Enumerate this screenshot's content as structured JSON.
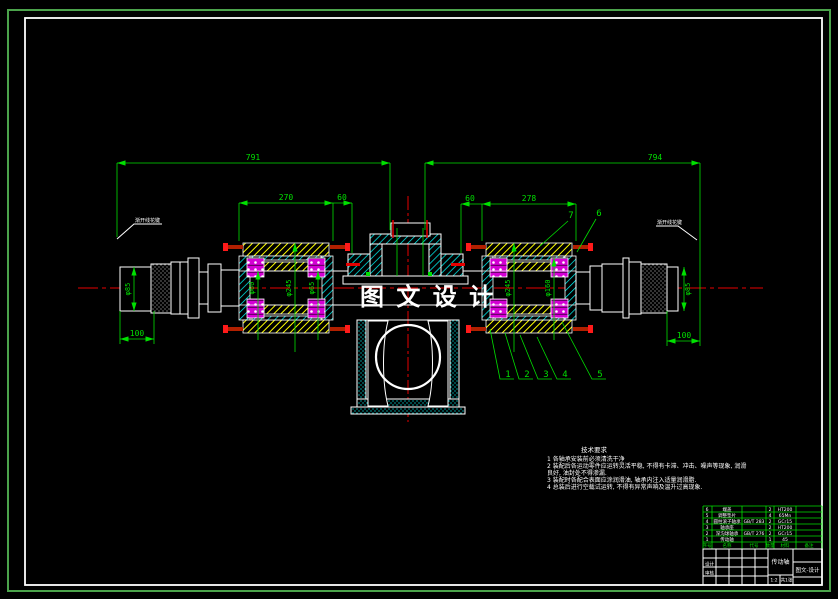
{
  "watermark": "图 文 设 计",
  "colors": {
    "background": "#000000",
    "border_green": "#4ba34b",
    "line_green": "#00e000",
    "centerline_red": "#e60000",
    "hatch_yellow": "#ffff00",
    "hatch_cyan": "#00ffff",
    "bearing_magenta": "#d400d4",
    "outline_white": "#ffffff"
  },
  "dimensions": {
    "span_left": "791",
    "span_right": "794",
    "left_housing": "270",
    "left_gap": "60",
    "right_gap": "60",
    "right_housing": "278",
    "left_end_dia": "φ85",
    "left_end_len": "100",
    "right_end_dia": "φ85",
    "right_end_len": "100",
    "left_dia_small": "φ60",
    "left_dia_big": "φ245",
    "left_dia_mid": "φ65",
    "right_dia_big": "φ245",
    "right_dia_mid": "φ160"
  },
  "balloons": [
    "1",
    "2",
    "3",
    "4",
    "5",
    "6",
    "7"
  ],
  "leader_notes": {
    "left": "渐开线花键",
    "right": "渐开线花键"
  },
  "notes": {
    "title": "技术要求",
    "lines": [
      "1  各轴承安装前必须清洗干净",
      "2  装配后各运动零件应运转灵活平稳, 不得有卡滞、冲击、噪声等现象, 润滑",
      "良好, 油封处不得渗漏.",
      "3  装配时各配合表面应涂润滑油, 轴承内注入适量润滑脂.",
      "4  总装后进行空载试运转, 不得有异常声响及温升过高现象."
    ]
  },
  "bom": {
    "header": [
      "序号",
      "名称",
      "代号",
      "数量",
      "材料",
      "备注"
    ],
    "rows": [
      {
        "no": "6",
        "name": "端盖",
        "code": "",
        "qty": "2",
        "mat": "HT200"
      },
      {
        "no": "5",
        "name": "调整垫片",
        "code": "",
        "qty": "4",
        "mat": "65Mn"
      },
      {
        "no": "4",
        "name": "圆柱滚子轴承",
        "code": "GB/T 283",
        "qty": "2",
        "mat": "GCr15"
      },
      {
        "no": "3",
        "name": "轴承座",
        "code": "",
        "qty": "2",
        "mat": "HT200"
      },
      {
        "no": "2",
        "name": "深沟球轴承",
        "code": "GB/T 276",
        "qty": "2",
        "mat": "GCr15"
      },
      {
        "no": "1",
        "name": "传动轴",
        "code": "",
        "qty": "1",
        "mat": "45"
      }
    ]
  },
  "title_block": {
    "part_name": "传动轴",
    "company": "图文-设计",
    "drawn_label": "设计",
    "checked_label": "审核",
    "scale": "1:2",
    "sheet": "共1张"
  }
}
